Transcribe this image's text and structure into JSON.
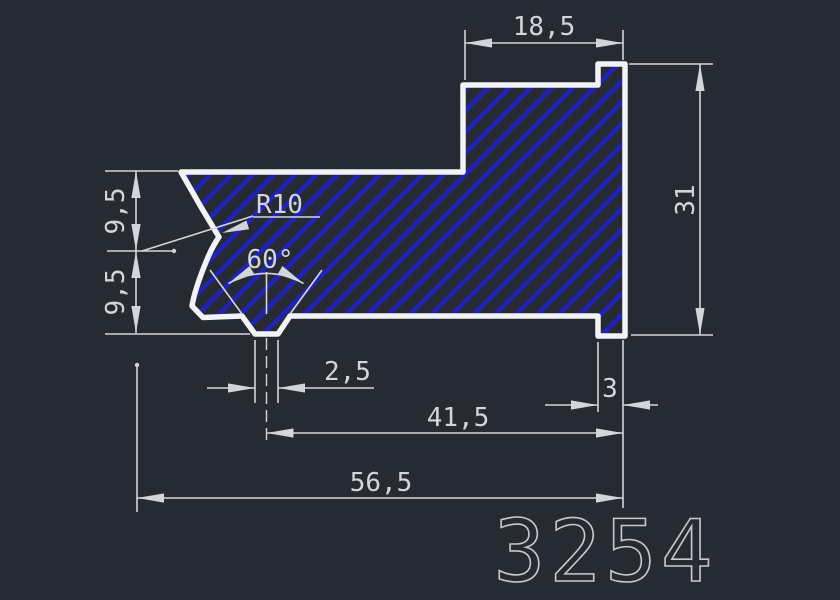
{
  "drawing": {
    "part_number": "3254",
    "dimensions": {
      "top_width": "18,5",
      "right_height": "31",
      "left_upper_height": "9,5",
      "left_lower_height": "9,5",
      "fillet_radius": "R10",
      "groove_angle": "60°",
      "tab_width": "2,5",
      "foot_width": "3",
      "tab_center_to_right": "41,5",
      "overall_width": "56,5"
    },
    "colors": {
      "background": "#262a32",
      "outline": "#f2f3f4",
      "hatch": "#2123b8",
      "dimension": "#d3d6d9",
      "part_number": "#c6cacd"
    }
  }
}
